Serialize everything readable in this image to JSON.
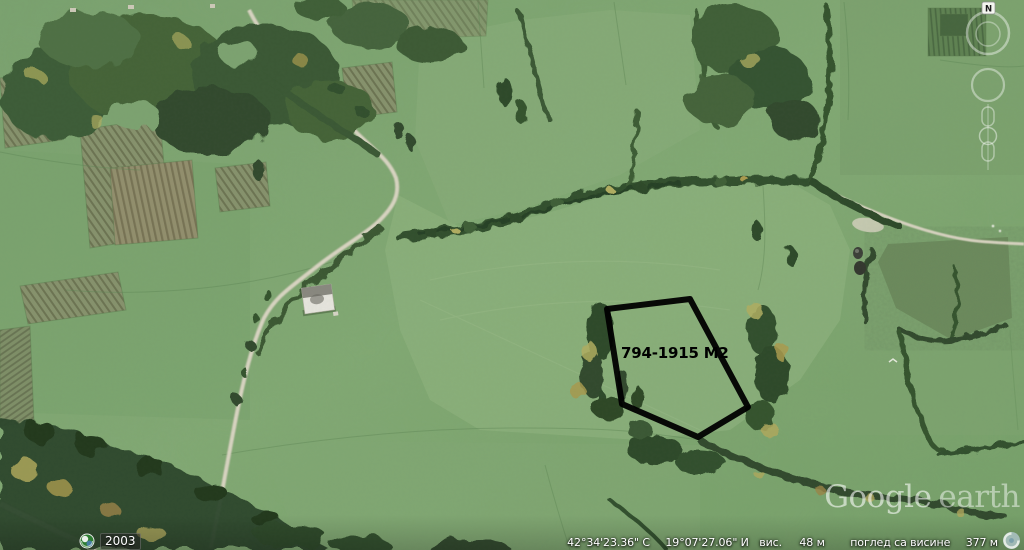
{
  "app": {
    "name": "Google Earth"
  },
  "map": {
    "parcel": {
      "label": "794-1915 M2",
      "outline_color": "#000000"
    },
    "imagery_year": "2003"
  },
  "nav": {
    "compass": "N"
  },
  "watermark": {
    "brand": "Google",
    "product": "earth"
  },
  "status_bar": {
    "latitude": "42°34'23.36\" С",
    "longitude": "19°07'27.06\" И",
    "elevation_label": "вис.",
    "elevation": "48 м",
    "eye_altitude_label": "поглед са висине",
    "eye_altitude": "377 м"
  },
  "icons": {
    "timeline": "clock-globe-icon",
    "streaming": "globe-swirl-icon",
    "compass_badge": "north-icon"
  },
  "colors": {
    "pasture_green": "#7da371",
    "forest_green": "#3a5834",
    "road": "#dcd7c5",
    "status_text": "#ffffff"
  }
}
